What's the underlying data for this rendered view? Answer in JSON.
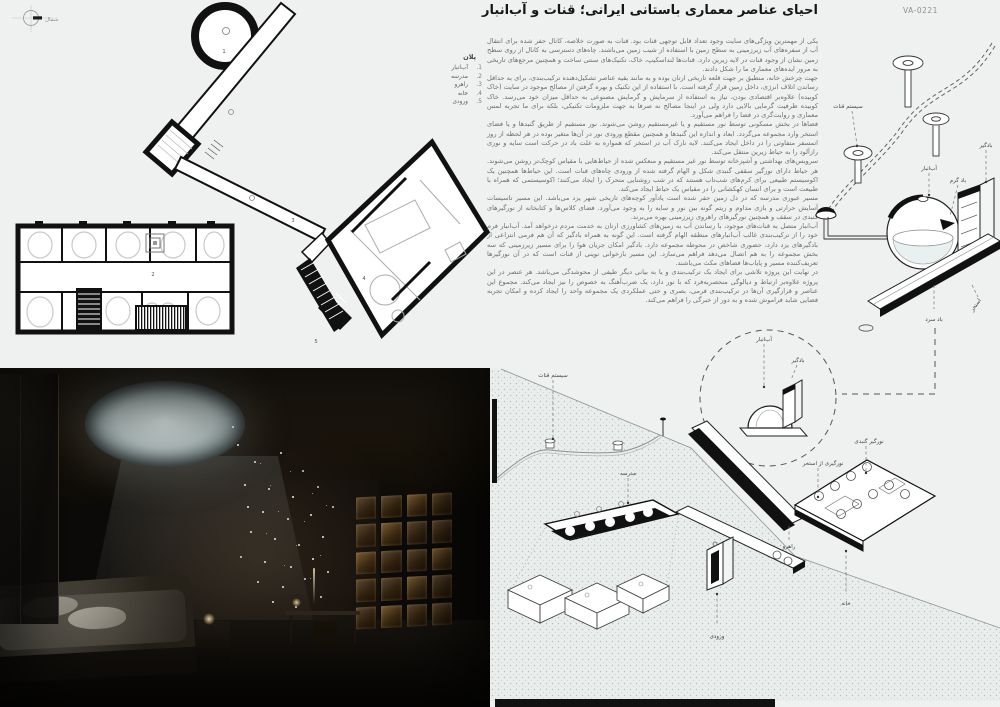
{
  "poster": {
    "code": "VA-0221",
    "title": "احیای عناصر معماری باستانی ایرانی؛ قنات و آب‌انبار",
    "north_label": "شمال"
  },
  "plan": {
    "legend_title": "پلان",
    "legend": [
      {
        "num": ".1",
        "label": "آب‌انبار"
      },
      {
        "num": ".2",
        "label": "مدرسه"
      },
      {
        "num": ".3",
        "label": "راهرو"
      },
      {
        "num": ".4",
        "label": "خانه"
      },
      {
        "num": ".5",
        "label": "ورودی"
      }
    ],
    "marks": {
      "m1": "1",
      "m2": "2",
      "m3": "3",
      "m4": "4",
      "m5": "5"
    }
  },
  "article": {
    "paragraphs": [
      "یکی از مهمترین ویژگی‌های سایت وجود تعداد قابل توجهی قنات بود. قنات به صورت خلاصه، کانال حفر شده برای انتقال آب از سفره‌های آب زیرزمینی به سطح زمین با استفاده از شیب زمین می‌باشند. چاه‌های دسترسی به کانال از روی سطح زمین نشان از وجود قنات در لایه زیرین دارد. قنات‌ها لنداسکیپ، خاک، تکنیک‌های سنتی ساخت و همچنین مرجع‌های تاریخی به مرور ایده‌های معماری ما را شکل دادند.",
      "جهت چرخش خانه، منطبق بر جهت قلعه تاریخی ارتان بوده و به مانند بقیه عناصر تشکیل‌دهنده ترکیب‌بندی، برای به حداقل رساندن اتلاف انرژی، داخل زمین قرار گرفته است. با استفاده از این تکنیک و بهره گرفتن از مصالح موجود در سایت (خاک کوبیده) علاوه‌بر اقتصادی بودن، نیاز به استفاده از سرمایش و گرمایش مصنوعی به حداقل میزان خود می‌رسد. خاک کوبیده ظرفیت گرمایی بالایی دارد ولی در اینجا مصالح نه صرفا به جهت ملزومات تکنیکی، بلکه برای ما تجربه لمس معماری و روایت‌گری در فضا را فراهم می‌آورد.",
      "فضاها در بخش مسکونی توسط نور مستقیم و یا غیرمستقیم روشن می‌شوند. نور مستقیم از طریق گنبدها و یا فضای استخر وارد مجموعه می‌گردد. ابعاد و اندازه این گنبدها و همچنین مقطع ورودی نور در آن‌ها متغیر بوده در هر لحظه از روز اتمسفر متفاوتی را در داخل ایجاد می‌کنند. لایه نازک آب در استخر که همواره به علت باد در حرکت است سایه و نوری رازآلود را به حیاط زیرین منتقل می‌کند.",
      "سرویس‌های بهداشتی و آشپزخانه توسط نور غیر مستقیم و منعکس شده از حیاط‌هایی با مقیاس کوچک‌تر روشن می‌شوند. هر حیاط دارای نورگیر سقفی گنبدی شکل و الهام گرفته شده از ورودی چاه‌های قنات است. این حیاط‌ها همچنین یک اکوسیستم طبیعی برای کرم‌های شب‌تاب هستند که در شب روشنایی متحرک را ایجاد می‌کنند؛ اکوسیستمی که همراه با طبیعت است و برای انسان کهکشانی را در مقیاس یک حیاط ایجاد می‌کند.",
      "مسیر عبوری مدرسه که در دل زمین حفر شده است یادآور کوچه‌های تاریخی شهر یزد می‌باشد. این مسیر تاسیسات آسایش حرارتی و بازی مداوم و ریتم گونه بین نور و سایه را به وجود می‌آورد. فضای کلاس‌ها و کتابخانه از نورگیرهای گنبدی در سقف و همچنین نورگیرهای راهروی زیرزمینی بهره می‌برند.",
      "آب‌انبار متصل به قنات‌های موجود، با رساندن آب به زمین‌های کشاورزی ارتان به خدمت مردم درخواهد آمد. آب‌انبار فرم خود را از ترکیب‌بندی غالب آب‌انبارهای منطقه الهام گرفته است. این گونه به همراه بادگیر که آن هم فرمی انتزاعی از بادگیرهای یزد دارد، حضوری شاخص در محوطه مجموعه دارد. بادگیر امکان جریان هوا را برای مسیر زیرزمینی که سه بخش مجموعه را به هم اتصال می‌دهد فراهم می‌سازد. این مسیر بازخوانی نوینی از قنات است که در آن نورگیرها تعریف‌کننده مسیر و پایاب‌ها فضاهای مکث می‌باشند.",
      "در نهایت این پروژه تلاشی برای ایجاد یک ترکیب‌بندی و یا به بیانی دیگر طیفی از محوشدگی می‌باشد. هر عنصر در این پروژه علاوه‌بر ارتباط و دیالوگی منحصربه‌فرد که با نور دارد، یک ضرب‌آهنگ به خصوص را نیز ایجاد می‌کند. مجموع این عناصر و قرارگیری آن‌ها در ترکیب‌بندی فرمی، بصری و حتی عملکردی یک مجموعه واحد را ایجاد کرده و امکان تجربه فضایی شاید فراموش شده و به دور از خبرگی را فراهم می‌کند."
    ]
  },
  "qanat_diagram": {
    "labels": {
      "system": "سیستم قنات",
      "cistern": "آب‌انبار",
      "windcatcher": "بادگیر",
      "warm_wind": "باد گرم",
      "cold_wind": "باد سرد",
      "pool": "استخر"
    }
  },
  "site_diagram": {
    "labels": {
      "system": "سیستم قنات",
      "cistern": "آب‌انبار",
      "windcatcher": "بادگیر",
      "dome_skylight": "نورگیر گنبدی",
      "pool_light": "نورگیری از استخر",
      "school": "مدرسه",
      "corridor": "راهرو",
      "house": "خانه",
      "entrance": "ورودی"
    }
  },
  "colors": {
    "background": "#eef1ef",
    "ink": "#141414",
    "body_text": "#6b706f",
    "stipple": "#b7bfbc"
  }
}
